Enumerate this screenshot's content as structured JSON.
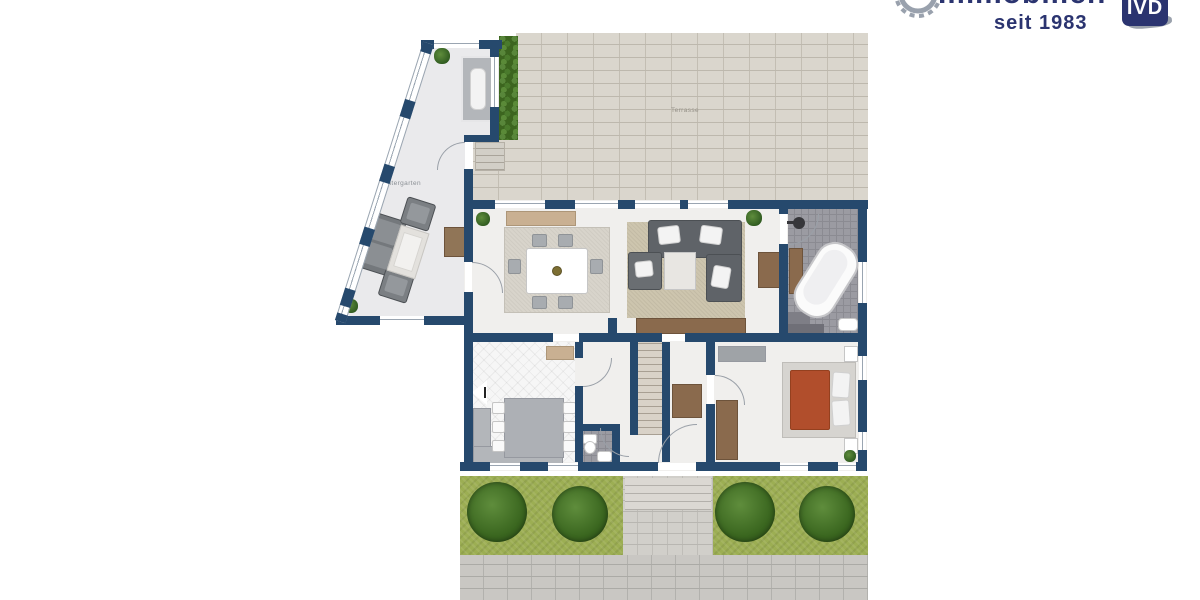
{
  "logo": {
    "brand_text": "Immobilien",
    "tagline": "seit 1983",
    "badge_text": "IVD",
    "brand_color": "#2b3470",
    "gear_color": "#99a1ad"
  },
  "floorplan": {
    "labels": {
      "wintergarten": "Wintergarten",
      "terrasse": "Terrasse"
    },
    "colors": {
      "wall": "#26496d",
      "terrace_brick": "#dad6cd",
      "grass": "#9cae53",
      "bath_tile": "#9b9ba2",
      "bed_duvet": "#b14e2c",
      "wood": "#8a6a4d",
      "sidewalk": "#c9c7c3"
    }
  }
}
